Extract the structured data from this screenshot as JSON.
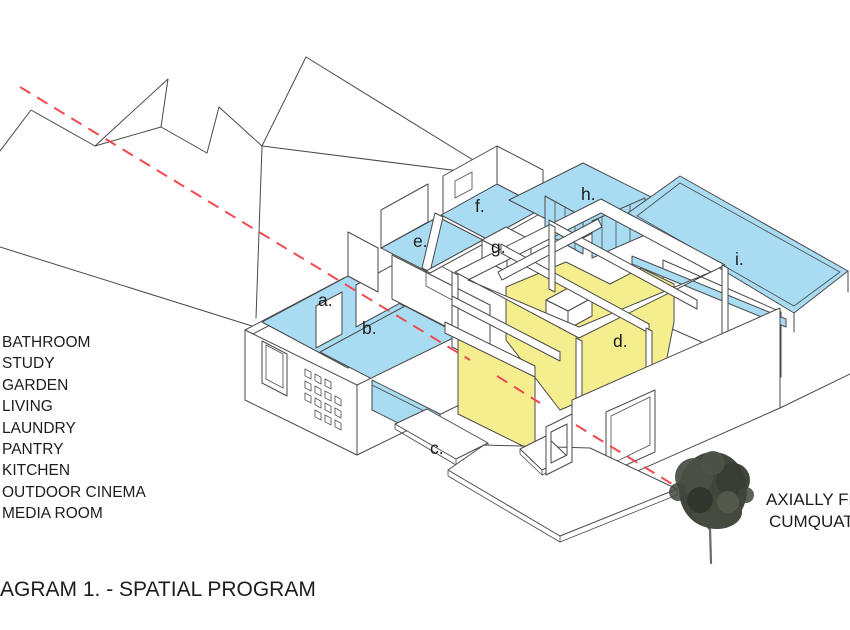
{
  "diagram": {
    "caption": "AGRAM 1. - SPATIAL PROGRAM",
    "legend_items": [
      "BATHROOM",
      "STUDY",
      "GARDEN",
      "LIVING",
      "LAUNDRY",
      "PANTRY",
      "KITCHEN",
      "OUTDOOR CINEMA",
      "MEDIA ROOM"
    ],
    "room_labels": {
      "a": "a.",
      "b": "b.",
      "c": "c.",
      "d": "d.",
      "e": "e.",
      "f": "f.",
      "g": "g.",
      "h": "h.",
      "i": "i."
    },
    "tree_annotation": {
      "line1": "AXIALLY FR",
      "line2": "CUMQUAT"
    },
    "colors": {
      "room_fill_blue": "#A9DCF2",
      "room_fill_yellow": "#F5EE8E",
      "axis_red": "#EF4B50",
      "outline": "#4A4A4A",
      "tree_foliage": "#41463C"
    }
  }
}
